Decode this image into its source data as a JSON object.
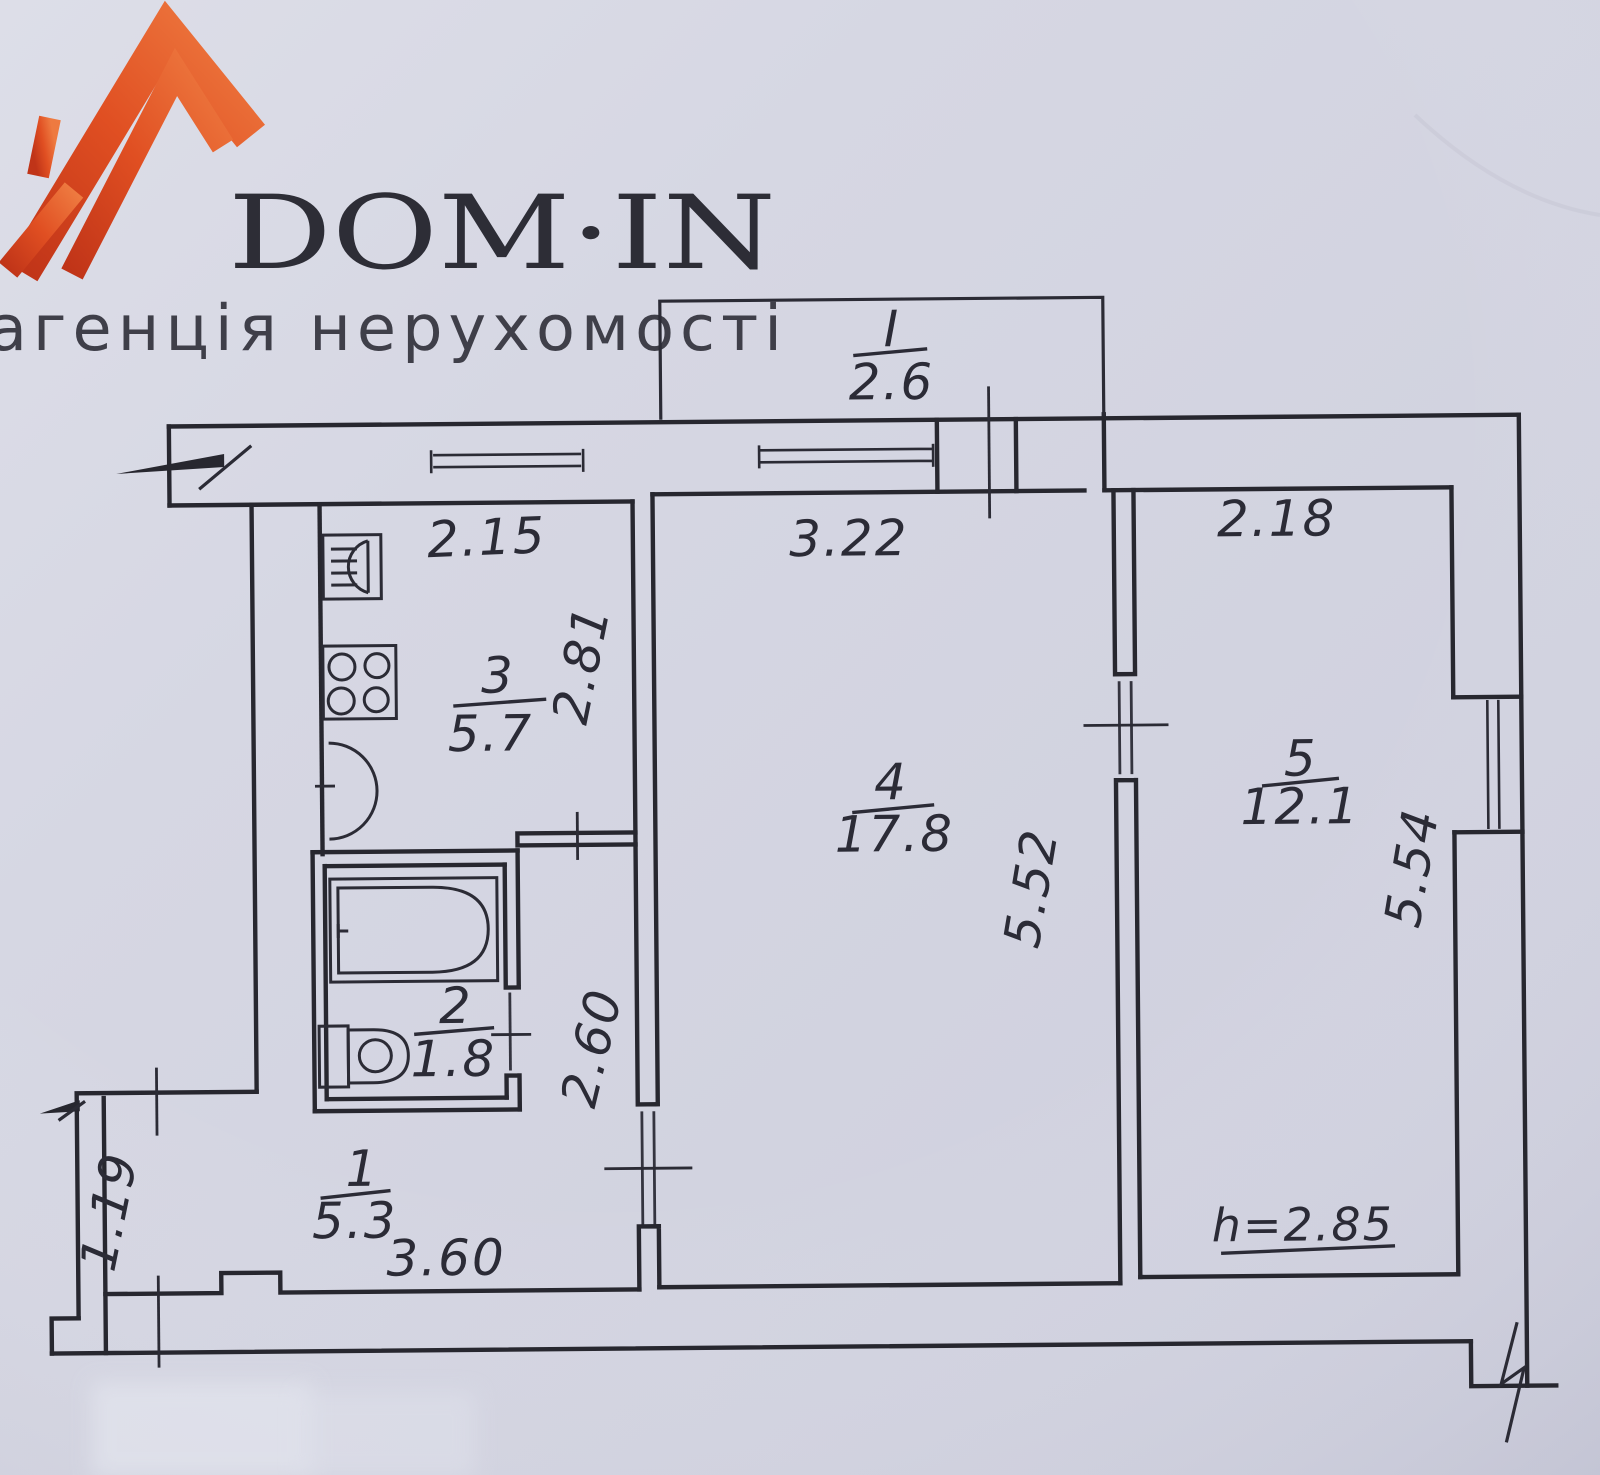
{
  "logo": {
    "title": "DOM·IN",
    "subtitle": "агенція нерухомості"
  },
  "rooms": {
    "balcony": {
      "number": "I",
      "area": "2.6"
    },
    "hall": {
      "number": "1",
      "area": "5.3"
    },
    "bath": {
      "number": "2",
      "area": "1.8"
    },
    "kitchen": {
      "number": "3",
      "area": "5.7"
    },
    "living": {
      "number": "4",
      "area": "17.8"
    },
    "bedroom": {
      "number": "5",
      "area": "12.1"
    }
  },
  "dims": {
    "kitchen_w": "2.15",
    "kitchen_d": "2.81",
    "living_w": "3.22",
    "living_d": "5.52",
    "bedroom_w": "2.18",
    "bedroom_d": "5.54",
    "corridor": "2.60",
    "hall_w": "3.60",
    "alcove": "1.19",
    "ceiling_height": "h=2.85"
  },
  "icons": {
    "roof": "roof-logo-icon",
    "sink": "kitchen-sink-icon",
    "stove": "stove-icon",
    "bathtub": "bathtub-icon",
    "toilet": "toilet-icon",
    "door_swing": "door-swing-arc-icon",
    "entrance_arrow": "entrance-arrow-icon",
    "break_mark": "wall-break-mark-icon"
  },
  "colors": {
    "paper": "#d4d5e1",
    "ink": "#27272f",
    "logo_orange": "#dd4a22",
    "logo_text": "#2d2d36"
  }
}
